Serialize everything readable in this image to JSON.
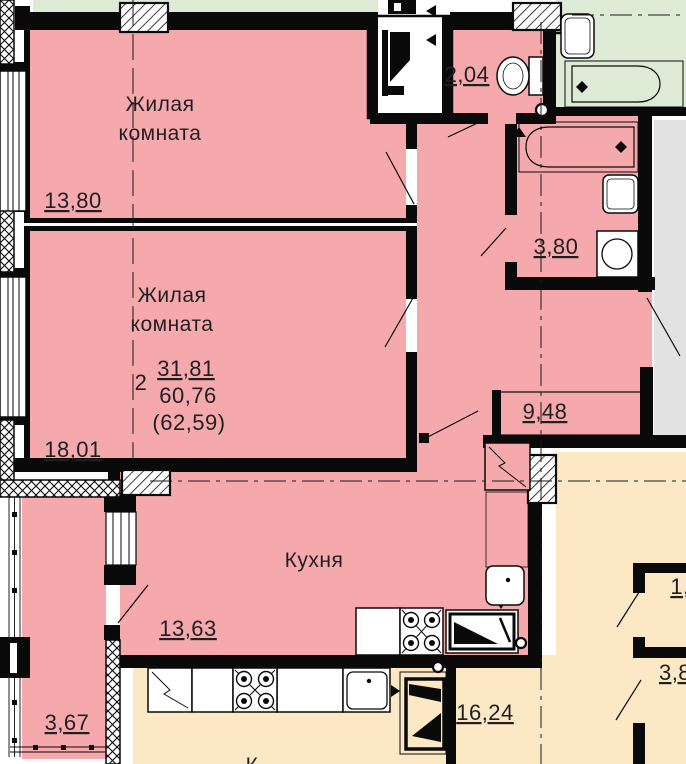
{
  "colors": {
    "floor_pink": "#f5a9ac",
    "neighbor_green": "#dcead6",
    "neighbor_orange": "#fce8c4",
    "corridor_gray": "#e3e2e2",
    "wall_black": "#0a0a0a",
    "text": "#1f1f1f"
  },
  "apartment": {
    "type_label": "2",
    "area_living": "31,81",
    "area_total": "60,76",
    "area_total_with_balcony": "(62,59)",
    "rooms": {
      "room1": {
        "name_line1": "Жилая",
        "name_line2": "комната",
        "area": "13,80"
      },
      "room2": {
        "name_line1": "Жилая",
        "name_line2": "комната",
        "area": "18,01"
      },
      "kitchen": {
        "name": "Кухня",
        "area": "13,63"
      },
      "wc": {
        "area": "2,04"
      },
      "bathroom": {
        "area": "3,80"
      },
      "hallway": {
        "area": "9,48"
      },
      "balcony": {
        "area": "3,67"
      }
    }
  },
  "neighbor_units": {
    "bottom": {
      "room_area": "16,24",
      "label_partial": "К"
    },
    "right": {
      "room1_area_partial": "1,",
      "room2_area_partial": "3,8"
    }
  }
}
